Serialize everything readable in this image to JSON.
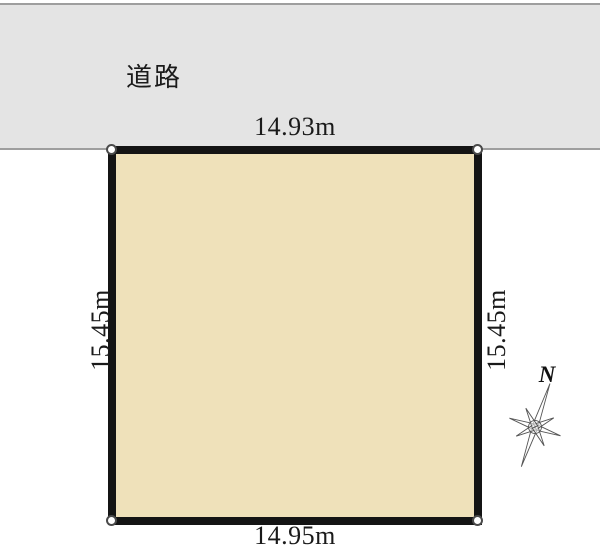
{
  "road": {
    "label": "道路"
  },
  "plot": {
    "top_dimension": "14.93m",
    "bottom_dimension": "14.95m",
    "left_dimension": "15.45m",
    "right_dimension": "15.45m"
  },
  "compass": {
    "north_label": "N"
  },
  "colors": {
    "road_fill": "#e4e4e4",
    "road_border": "#9e9e9e",
    "plot_fill": "#efe1ba",
    "plot_border": "#141414",
    "text": "#1a1a1a"
  }
}
